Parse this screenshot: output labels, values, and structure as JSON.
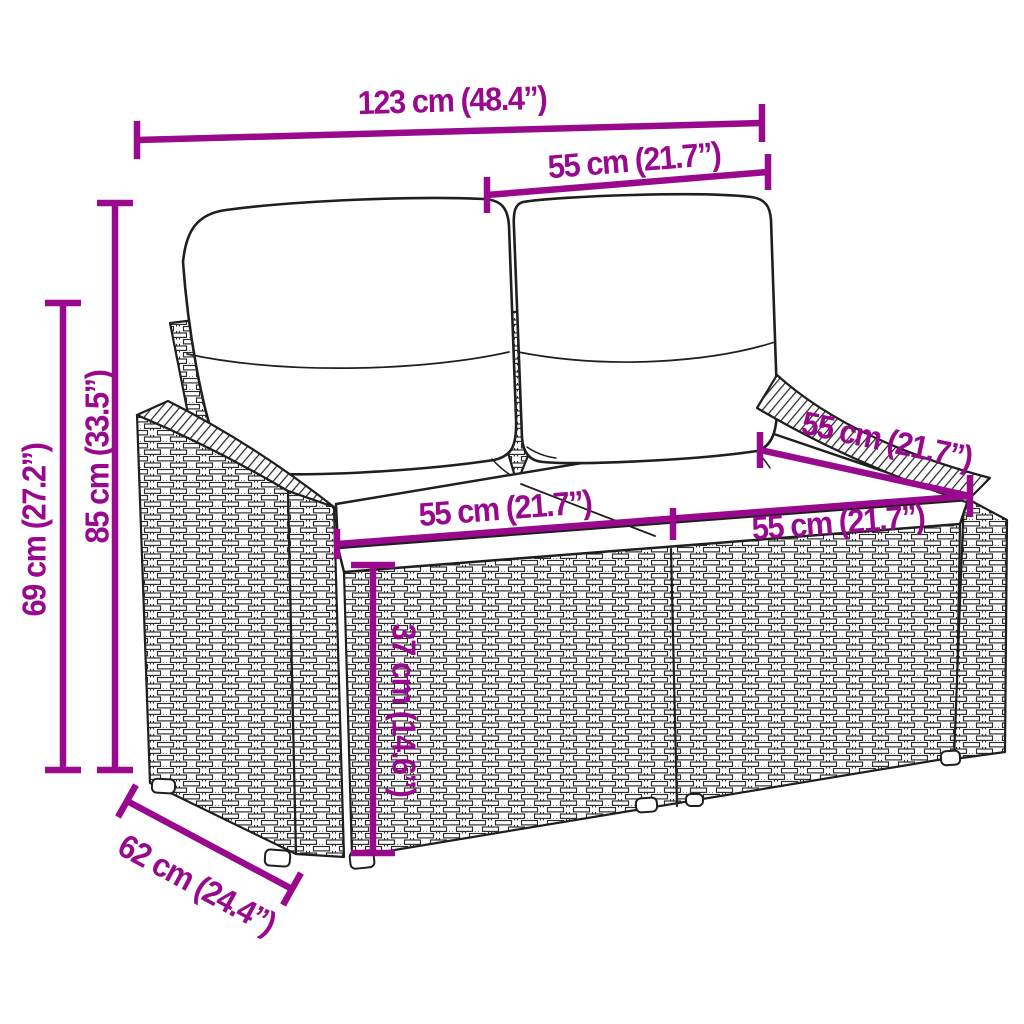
{
  "diagram": {
    "type": "product dimension diagram",
    "subject": "poly rattan 2-seater garden sofa with back and seat cushions",
    "unit_primary": "cm",
    "unit_secondary": "inches"
  },
  "colors": {
    "accent": "#99098d",
    "line": "#1f1f1f",
    "background": "#ffffff"
  },
  "dimensions": {
    "total_width": {
      "label": "123 cm (48.4”)",
      "cm": 123,
      "inches": 48.4
    },
    "backrest_width": {
      "label": "55 cm (21.7”)",
      "cm": 55,
      "inches": 21.7
    },
    "total_height": {
      "label": "85 cm (33.5”)",
      "cm": 85,
      "inches": 33.5
    },
    "arm_height": {
      "label": "69 cm (27.2”)",
      "cm": 69,
      "inches": 27.2
    },
    "seat_width_left": {
      "label": "55 cm (21.7”)",
      "cm": 55,
      "inches": 21.7
    },
    "seat_width_right": {
      "label": "55 cm (21.7”)",
      "cm": 55,
      "inches": 21.7
    },
    "seat_depth": {
      "label": "55 cm (21.7”)",
      "cm": 55,
      "inches": 21.7
    },
    "seat_height": {
      "label": "37 cm (14.6”)",
      "cm": 37,
      "inches": 14.6
    },
    "total_depth": {
      "label": "62 cm (24.4”)",
      "cm": 62,
      "inches": 24.4
    }
  }
}
